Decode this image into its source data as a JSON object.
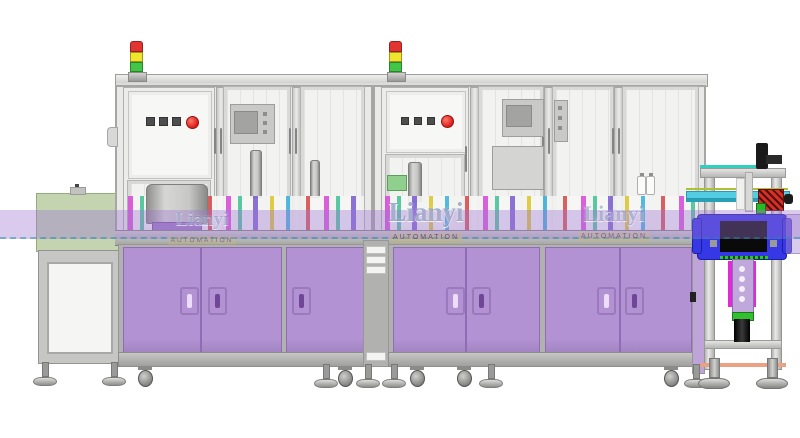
{
  "scene": {
    "description": "Side-view CAD render of an automated assembly machine line with two enclosed modules, infeed conveyor and end-of-line station",
    "watermark": {
      "brand": "Lianyi",
      "subtitle": "AUTOMATION"
    }
  },
  "colors": {
    "cabinet-purple": "#b292d3",
    "cabinet-purple-dark": "#9a79bd",
    "band-purple": "rgba(158,118,210,0.38)",
    "tunnel-green": "rgba(148,176,112,0.55)",
    "tower-red": "#e23430",
    "tower-yellow": "#f0e42c",
    "tower-green": "#42c646",
    "button-red": "#e02020",
    "housing-blue": "#3638e6",
    "rail-cyan": "#52cde2",
    "accent-magenta": "#e02ad8",
    "belt-green": "#2ec32e",
    "clamp-red": "#d43028",
    "base-orange": "#eca183"
  },
  "indicators": {
    "tower_lights": [
      "red",
      "yellow",
      "green"
    ],
    "panel_square_buttons": 3,
    "panel_round_buttons": 1
  }
}
